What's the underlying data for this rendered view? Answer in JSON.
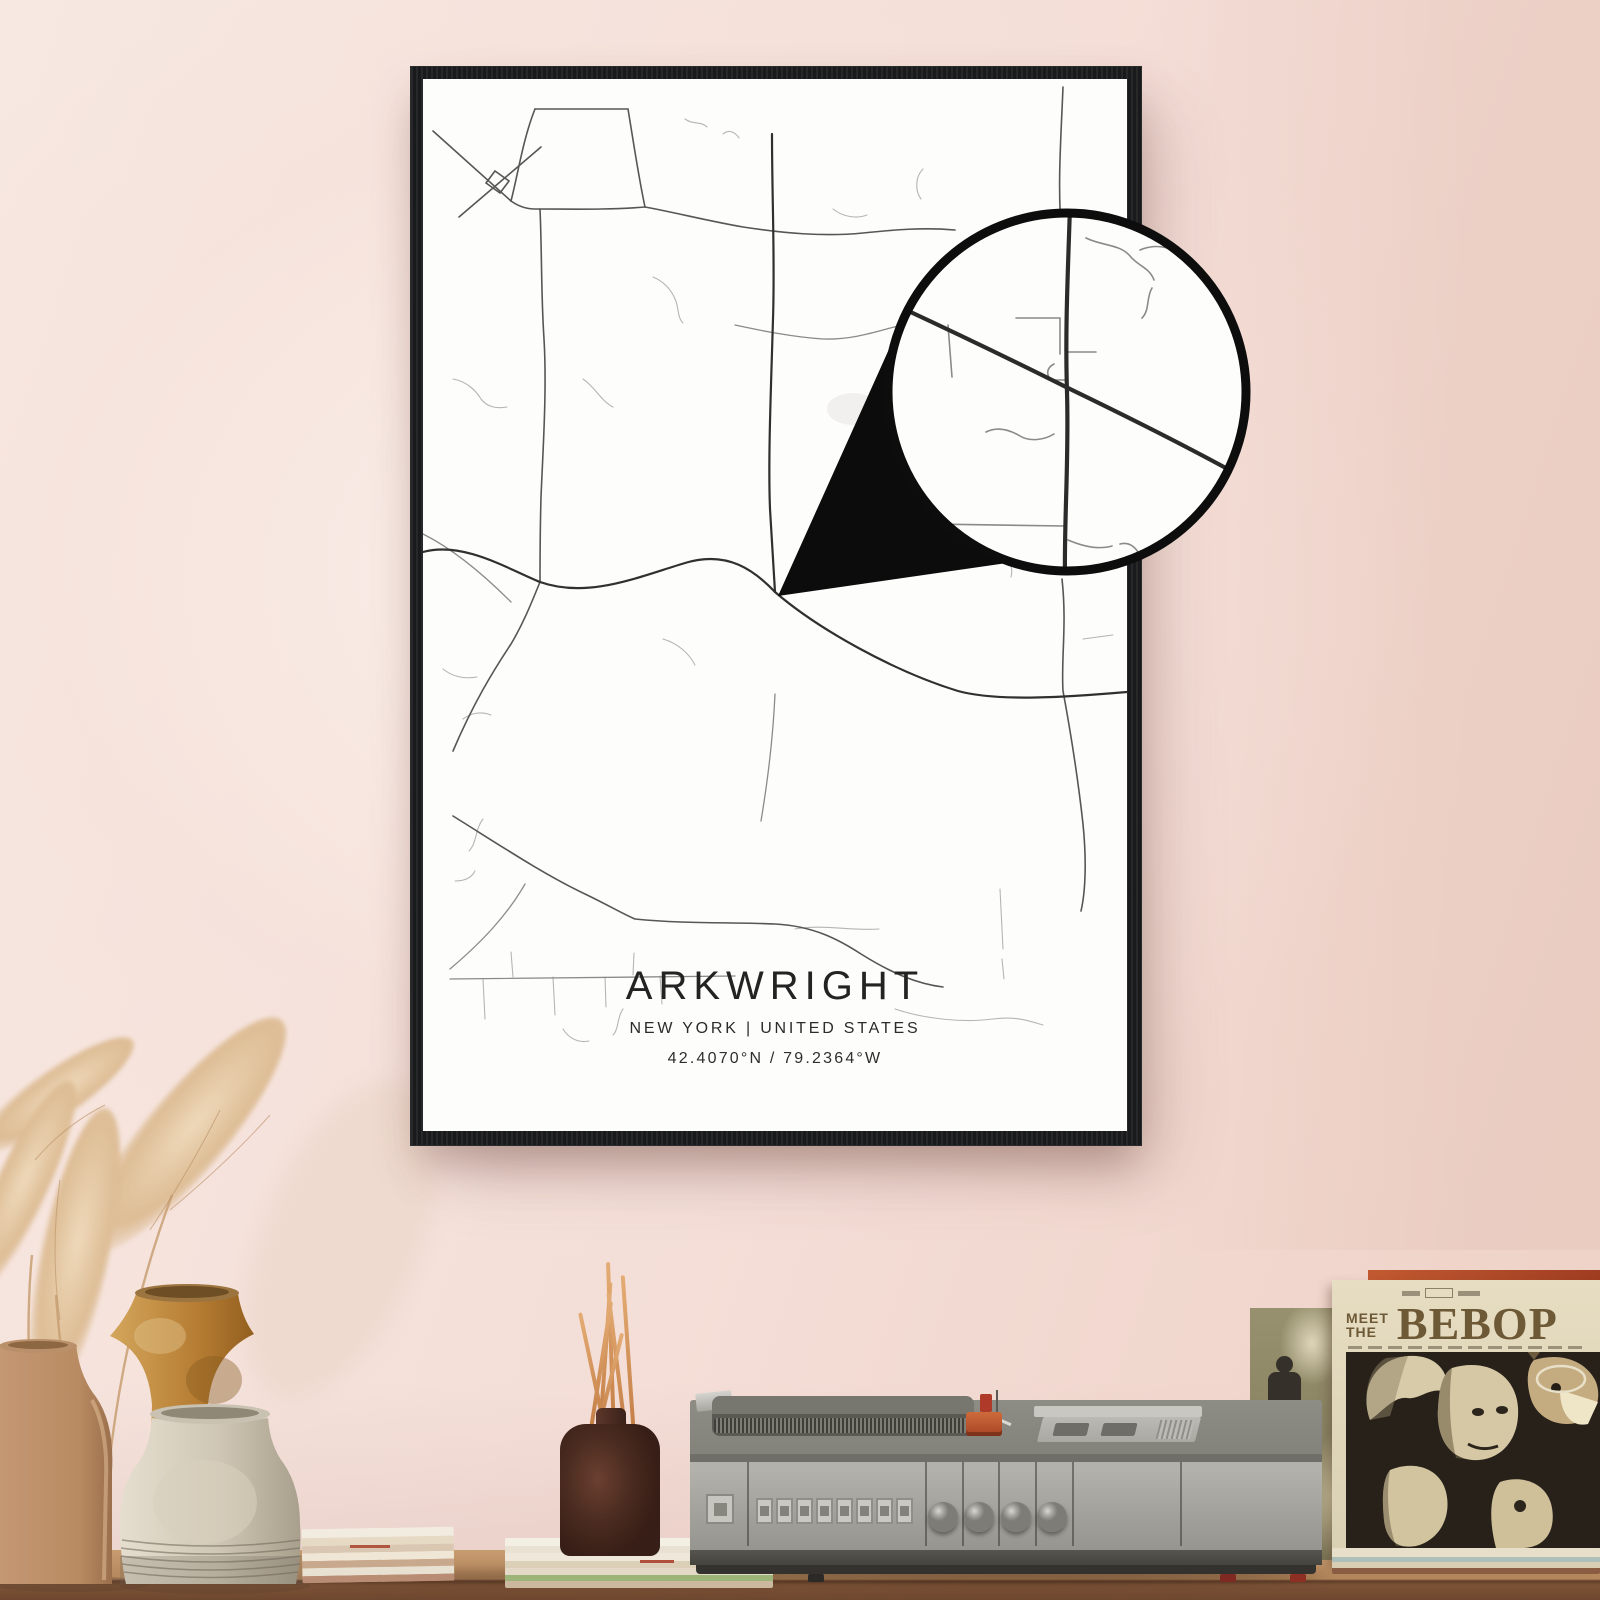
{
  "poster": {
    "title": "ARKWRIGHT",
    "subtitle": "NEW YORK | UNITED STATES",
    "coordinates": "42.4070°N / 79.2364°W"
  },
  "album": {
    "pretitle_line1": "MEET",
    "pretitle_line2": "THE",
    "title": "BEBOP"
  },
  "colors": {
    "wall_pink": "#f4ded7",
    "frame_black": "#1c1d1f",
    "poster_paper": "#fdfdfc",
    "road_dark": "#2f2f2f",
    "road_light": "#a9a9a9",
    "magnifier_ring": "#0d0d0d",
    "sleeve_cream": "#e2d8bd",
    "sleeve_text_brown": "#6e5936",
    "accent_red_stripe": "#b5502e",
    "turntable_gray": "#a3a29c",
    "vase_amber": "#c28a42",
    "vase_tan": "#c69b78",
    "vase_gray": "#d5cebd",
    "table_wood": "#b4875c"
  },
  "icons": {
    "magnifier": "zoom-inset-circle",
    "pointer": "zoom-pointer-wedge"
  }
}
